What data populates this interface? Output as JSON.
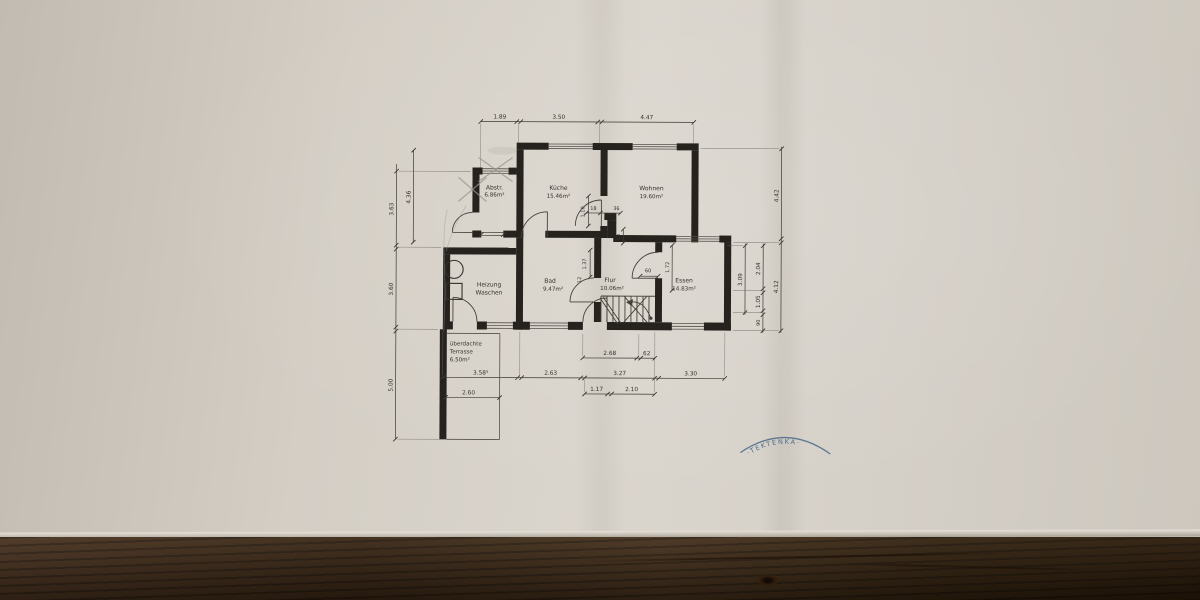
{
  "scene": {
    "paper_color": "#d6d1c9",
    "wood_color": "#3a2716",
    "ink_color": "#26231f",
    "pencil_color": "#9b948a",
    "stamp_color": "#3d6185"
  },
  "plan": {
    "rooms": [
      {
        "name": "Abstr.",
        "area": "6.86m²"
      },
      {
        "name": "Küche",
        "area": "15.46m²"
      },
      {
        "name": "Wohnen",
        "area": "19.60m²"
      },
      {
        "name": "Heizung",
        "name2": "Waschen",
        "area": ""
      },
      {
        "name": "Bad",
        "area": "9.47m²"
      },
      {
        "name": "Flur",
        "area": "10.06m²"
      },
      {
        "name": "Essen",
        "area": "14.83m²"
      },
      {
        "name": "überdachte",
        "name2": "Terrasse",
        "area": "6.50m²"
      }
    ],
    "dimensions": {
      "top": [
        "1.89",
        "3.50",
        "4.47"
      ],
      "left_outer": [
        "3.63",
        "3.60",
        "5.00"
      ],
      "left_inner": "4.36",
      "right_inner": "3.09",
      "right_middle": [
        "2.04",
        "1.05",
        "90"
      ],
      "right_outer": [
        "4.42",
        "4.12"
      ],
      "stair_row": [
        "2.68",
        "62"
      ],
      "bottom_row": [
        "3.58⁵",
        "2.63",
        "3.27",
        "3.30"
      ],
      "entry_row": [
        "1.17",
        "2.10"
      ],
      "terrace": "2.60",
      "interior": [
        "18",
        "36",
        "1.10",
        "43",
        "1.37",
        "12",
        "60",
        "1.72"
      ]
    },
    "watermark": "·TEKTENKA·"
  }
}
